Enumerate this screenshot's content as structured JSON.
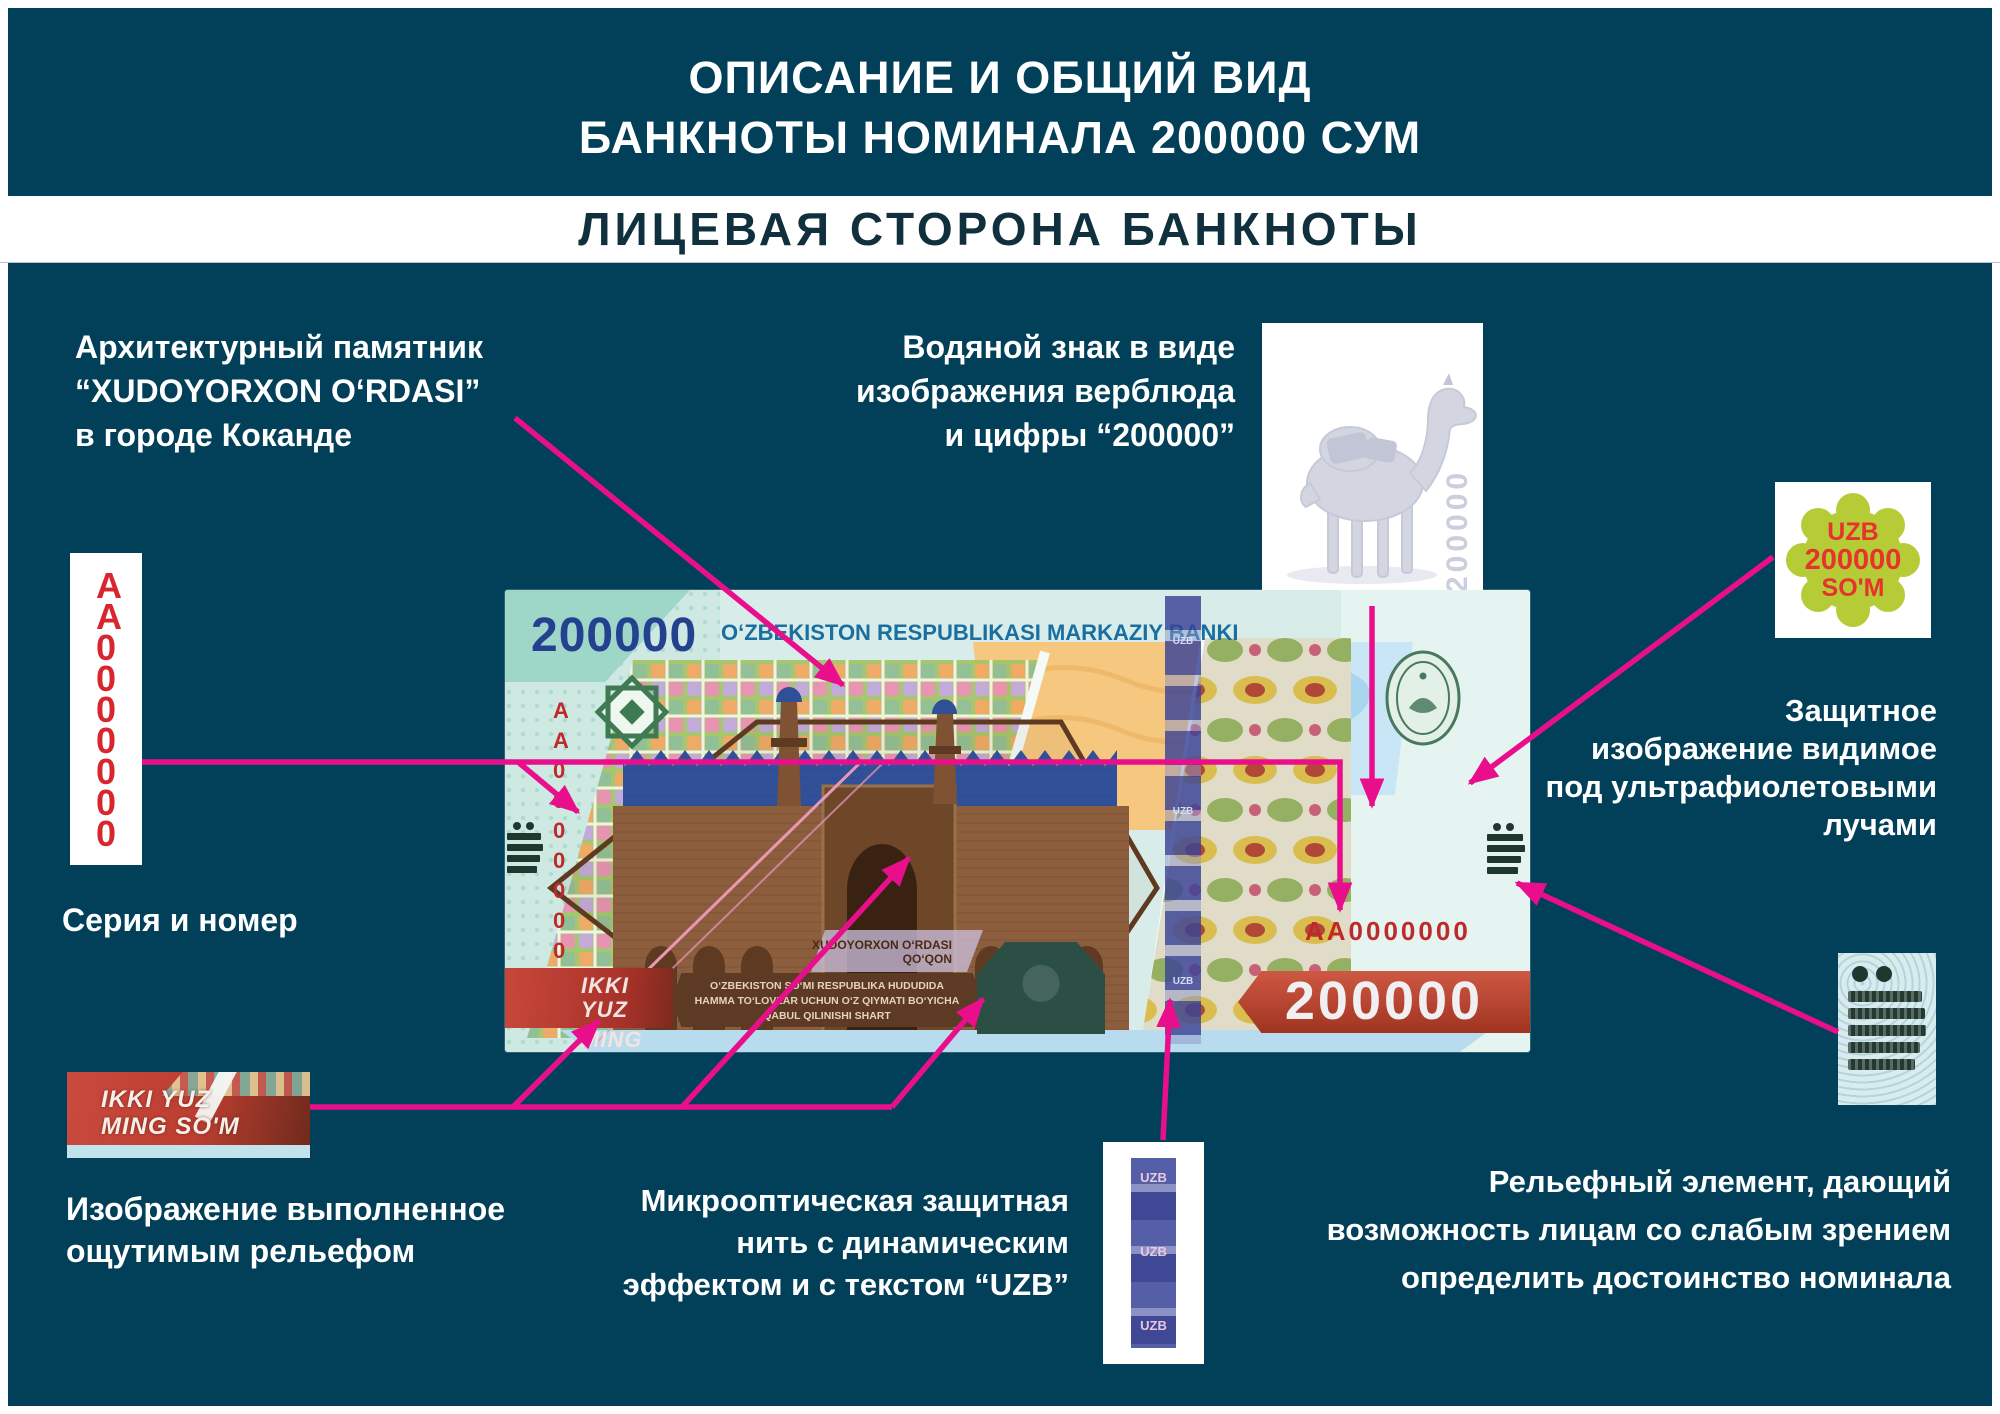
{
  "page": {
    "background": "#02405A",
    "accent_pink": "#E90F8C",
    "serial_red": "#D9262E"
  },
  "header": {
    "title_line1": "ОПИСАНИЕ И ОБЩИЙ ВИД",
    "title_line2": "БАНКНОТЫ НОМИНАЛА 200000 СУМ",
    "subtitle_banner": "ЛИЦЕВАЯ СТОРОНА БАНКНОТЫ"
  },
  "callouts": {
    "architecture": {
      "line1": "Архитектурный памятник",
      "line2": "“XUDOYORXON O‘RDASI”",
      "line3": "в городе Коканде"
    },
    "watermark": {
      "line1": "Водяной знак в виде",
      "line2": "изображения верблюда",
      "line3": "и цифры “200000”",
      "watermark_number": "200000"
    },
    "uv_badge": {
      "line1": "UZB",
      "line2": "200000",
      "line3": "SO'M"
    },
    "uv": {
      "line1": "Защитное",
      "line2": "изображение видимое",
      "line3": "под ультрафиолетовыми",
      "line4": "лучами"
    },
    "serial": {
      "box_text": "AA0000000",
      "caption": "Серия и номер"
    },
    "tactile_image": {
      "line1": "IKKI YUZ",
      "line2": "MING SO'M",
      "caption_line1": "Изображение выполненное",
      "caption_line2": "ощутимым рельефом"
    },
    "microoptic": {
      "line1": "Микрооптическая защитная",
      "line2": "нить с динамическим",
      "line3": "эффектом и с текстом “UZB”",
      "thread_text": "UZB"
    },
    "relief_element": {
      "line1": "Рельефный элемент, дающий",
      "line2": "возможность лицам со слабым зрением",
      "line3": "определить достоинство номинала"
    }
  },
  "banknote": {
    "denomination_top": "200000",
    "bank_name": "O‘ZBEKISTON RESPUBLIKASI MARKAZIY BANKI",
    "serial_vertical": "AA0000000",
    "serial_horizontal": "AA0000000",
    "monument_line1": "XUDOYORXON O‘RDASI",
    "monument_line2": "QO‘QON",
    "legal_line1": "O‘ZBEKISTON SO‘MI RESPUBLIKA HUDUDIDA",
    "legal_line2": "HAMMA TO‘LOVLAR UCHUN O‘Z QIYMATI BO‘YICHA",
    "legal_line3": "QABUL QILINISHI SHART",
    "value_words_line1": "IKKI YUZ",
    "value_words_line2": "MING SO'M",
    "denomination_bottom": "200000",
    "thread_text": "UZB"
  }
}
